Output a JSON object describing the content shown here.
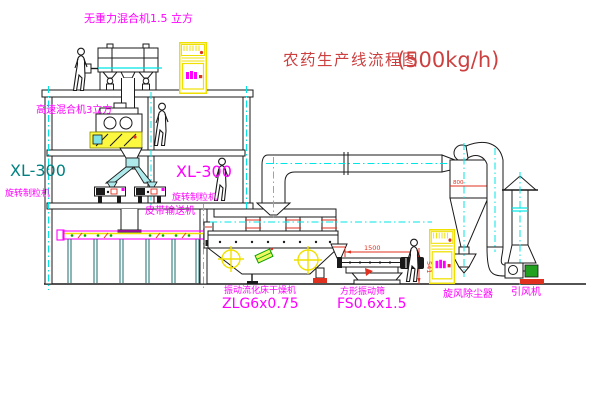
{
  "diagram": {
    "title_text": "农药生产线流程图",
    "title_capacity": "(500kg/h)"
  },
  "labels": {
    "gravity_mixer": "无重力混合机1.5 立方",
    "high_speed_mixer": "高速混合机3立方",
    "granulator_left_model": "XL-300",
    "granulator_left_name": "旋转制粒机",
    "granulator_mid_model": "XL-300",
    "granulator_mid_name": "旋转制粒机",
    "belt_conveyor": "皮带输送机",
    "dryer_name": "振动流化床干燥机",
    "dryer_model": "ZLG6x0.75",
    "sieve_name": "方形振动筛",
    "sieve_model": "FS0.6x1.5",
    "cyclone_name": "旋风除尘器",
    "fan_name": "引风机"
  },
  "dimensions": {
    "sieve_length": "1500",
    "sieve_height": "541",
    "cyclone_note": "800"
  },
  "colors": {
    "label_magenta": "#ff00ff",
    "title_red": "#cc4040",
    "model_teal": "#008080",
    "centerline_cyan": "#00e5e5",
    "highlight_yellow": "#efe000",
    "machine_green": "#22a020",
    "accent_red": "#e03020",
    "line_black": "#1a1a1a"
  }
}
